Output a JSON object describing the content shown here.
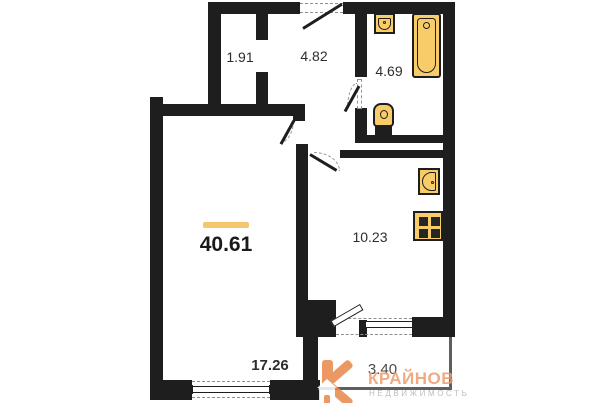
{
  "floorplan": {
    "title": "apartment floor plan",
    "total": {
      "area": "40.61"
    },
    "rooms": [
      {
        "name": "closet",
        "area": "1.91"
      },
      {
        "name": "hallway",
        "area": "4.82"
      },
      {
        "name": "bathroom",
        "area": "4.69"
      },
      {
        "name": "kitchen",
        "area": "10.23"
      },
      {
        "name": "living-room",
        "area": "17.26"
      },
      {
        "name": "balcony",
        "area": "3.40"
      }
    ],
    "fixtures": [
      "bathroom-sink-icon",
      "bathtub-icon",
      "toilet-icon",
      "kitchen-sink-icon",
      "stove-icon"
    ]
  },
  "logo": {
    "letter": "К",
    "title": "КРАЙНОВ",
    "subtitle": "НЕДВИЖИМОСТЬ"
  },
  "colors": {
    "wall": "#1e1e1e",
    "fix": "#F8CC69",
    "accent": "#F4C76D",
    "logo1": "#E8874A",
    "logo2": "#EE9C6E",
    "logo3": "#B6B1AF"
  }
}
